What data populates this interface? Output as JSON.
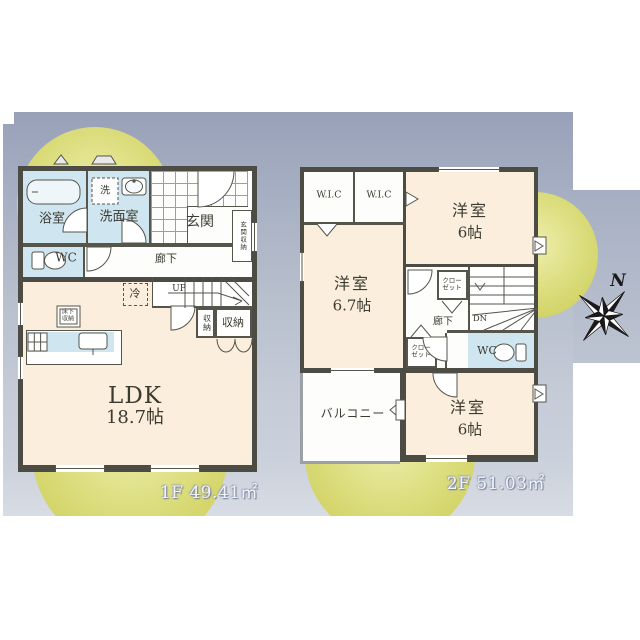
{
  "colors": {
    "band_top": "#98a1b8",
    "band_bottom": "#d8dce4",
    "accent_circle": "#d5d66e",
    "room_cream": "#fbeedd",
    "room_wet": "#cfe5f0",
    "wall": "#4c4c44",
    "text": "#3b3b31"
  },
  "compass": {
    "north_label": "N"
  },
  "floor1": {
    "area_label": "1F 49.41㎡",
    "labels": {
      "bath": "浴室",
      "washroom": "洗面室",
      "washer": "洗",
      "wc": "WC",
      "entrance": "玄関",
      "entrance_storage": "玄関収納",
      "hallway": "廊下",
      "stairs_up": "UP",
      "fridge": "冷",
      "storage_small": "収納",
      "storage": "収納",
      "underfloor_storage_line1": "床下",
      "underfloor_storage_line2": "収納",
      "ldk_name": "LDK",
      "ldk_size": "18.7帖"
    }
  },
  "floor2": {
    "area_label": "2F 51.03㎡",
    "labels": {
      "wic_left": "W.I.C",
      "wic_right": "W.I.C",
      "bedroom_top_name": "洋室",
      "bedroom_top_size": "6帖",
      "bedroom_left_name": "洋室",
      "bedroom_left_size": "6.7帖",
      "closet_hall_line1": "クロー",
      "closet_hall_line2": "ゼット",
      "closet_lower_line1": "クロー",
      "closet_lower_line2": "ゼット",
      "hallway": "廊下",
      "stairs_down": "DN",
      "wc": "WC",
      "balcony": "バルコニー",
      "bedroom_bottom_name": "洋室",
      "bedroom_bottom_size": "6帖"
    }
  }
}
